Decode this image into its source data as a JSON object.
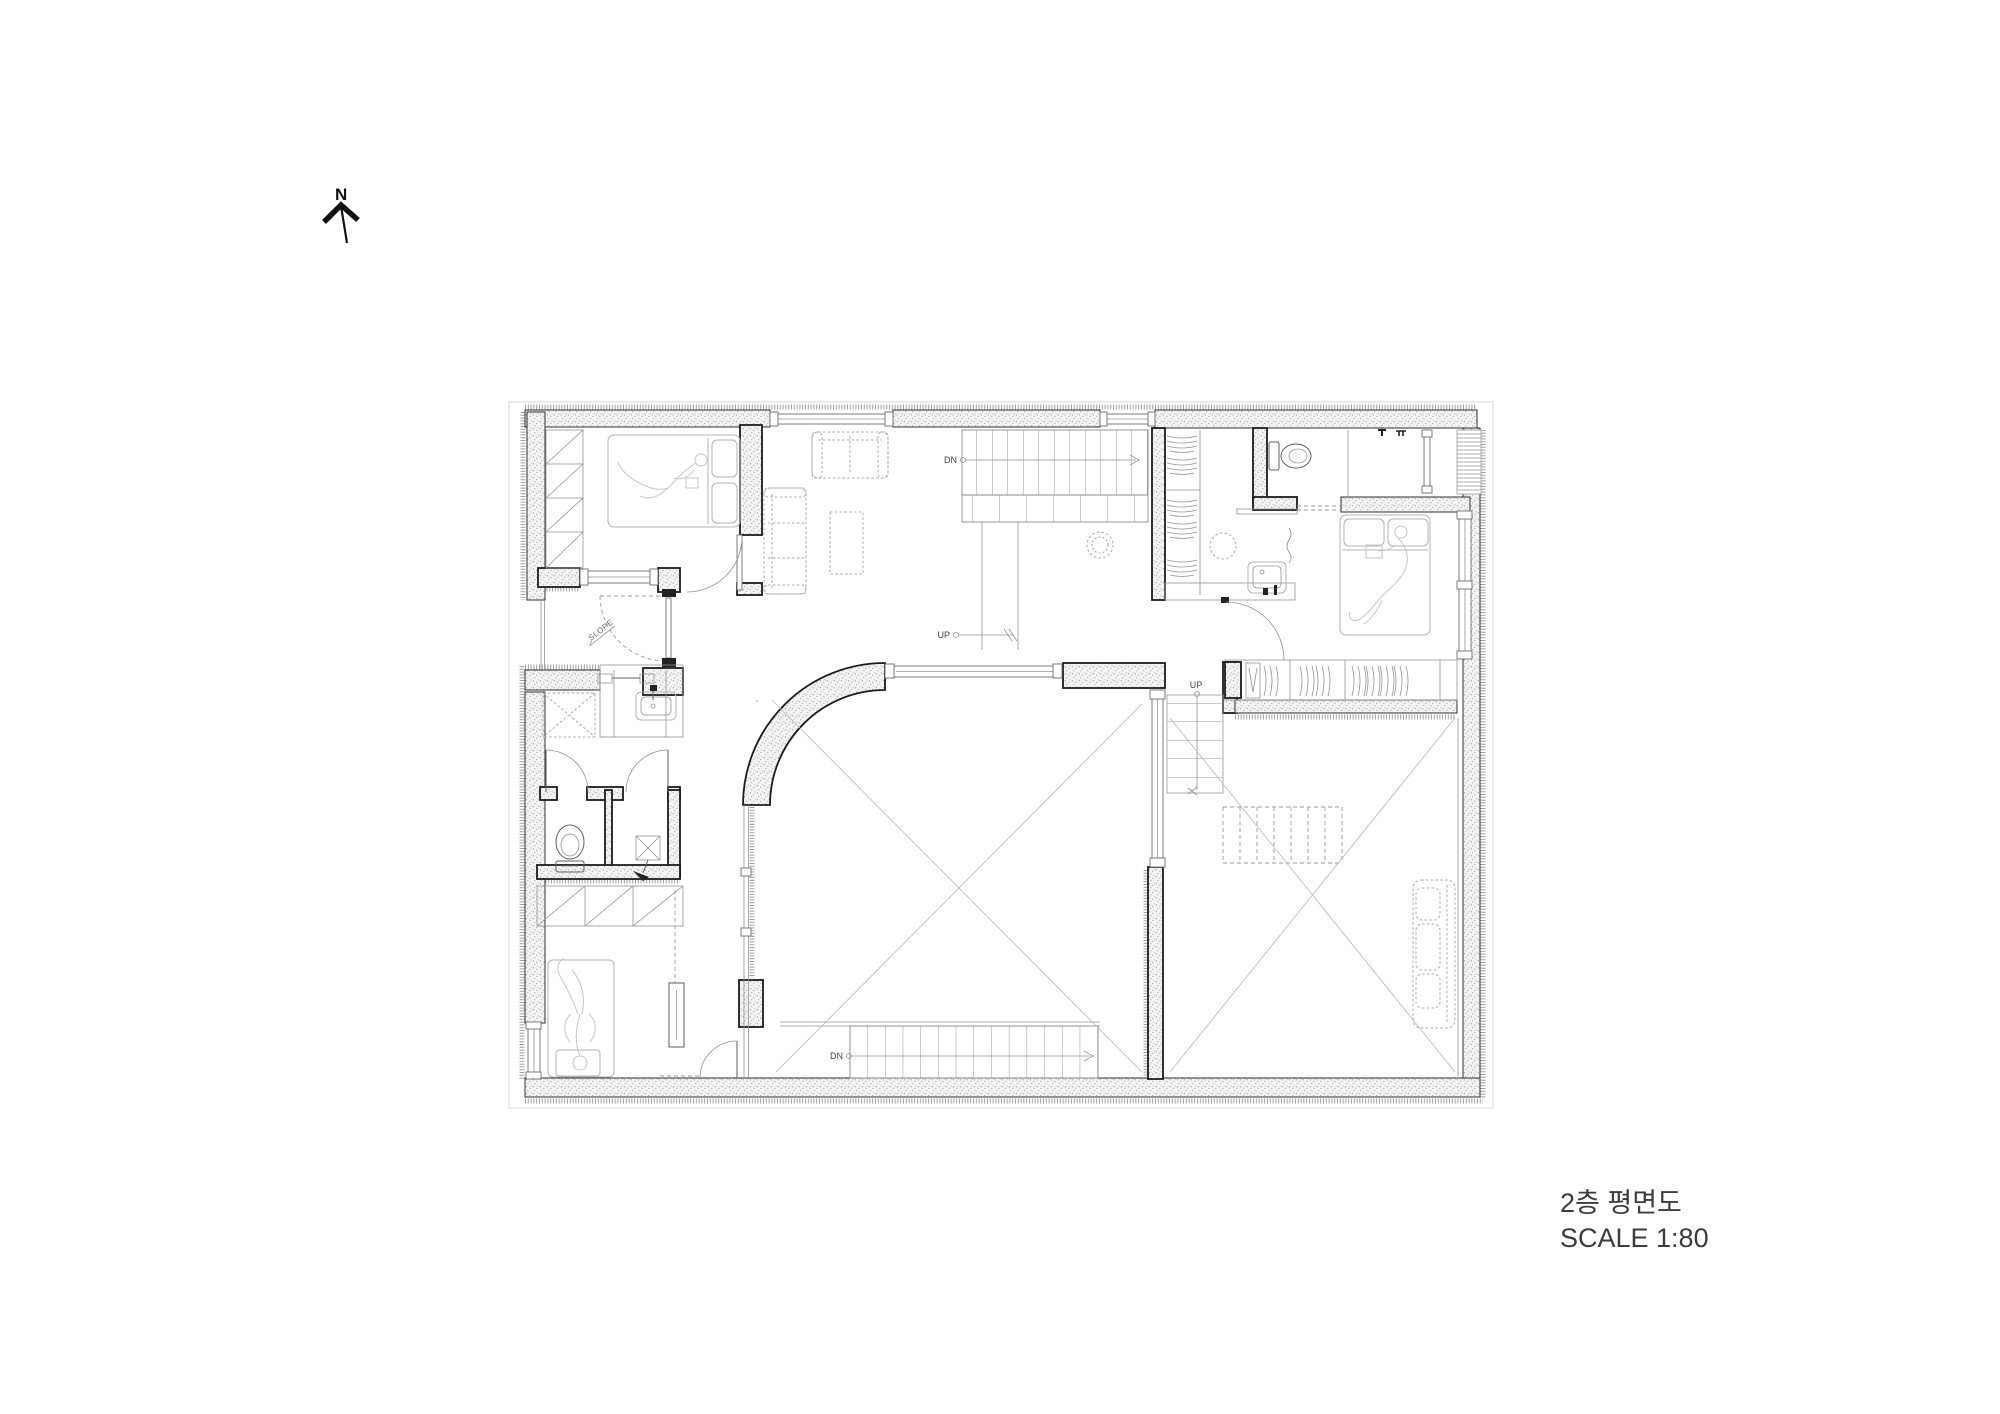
{
  "theme": {
    "background": "#ffffff",
    "wall_fill": "#f3f3f3",
    "wall_dot": "#a3a3a3",
    "line_dark": "#2f2f2f",
    "line_mid": "#5f5f5f",
    "line_light": "#949494",
    "furniture": "#b4b4b4",
    "person": "#c7c7c7",
    "text_color": "#3d3d3d"
  },
  "north_indicator": {
    "label": "N"
  },
  "floor_plan": {
    "labels": {
      "stair_main_down": "DN",
      "stair_main_up": "UP",
      "stair_side_up": "UP",
      "stair_bottom_down": "DN",
      "slope_note": "SLOPE"
    }
  },
  "title_block": {
    "drawing_title": "2층 평면도",
    "scale_note": "SCALE 1:80"
  }
}
